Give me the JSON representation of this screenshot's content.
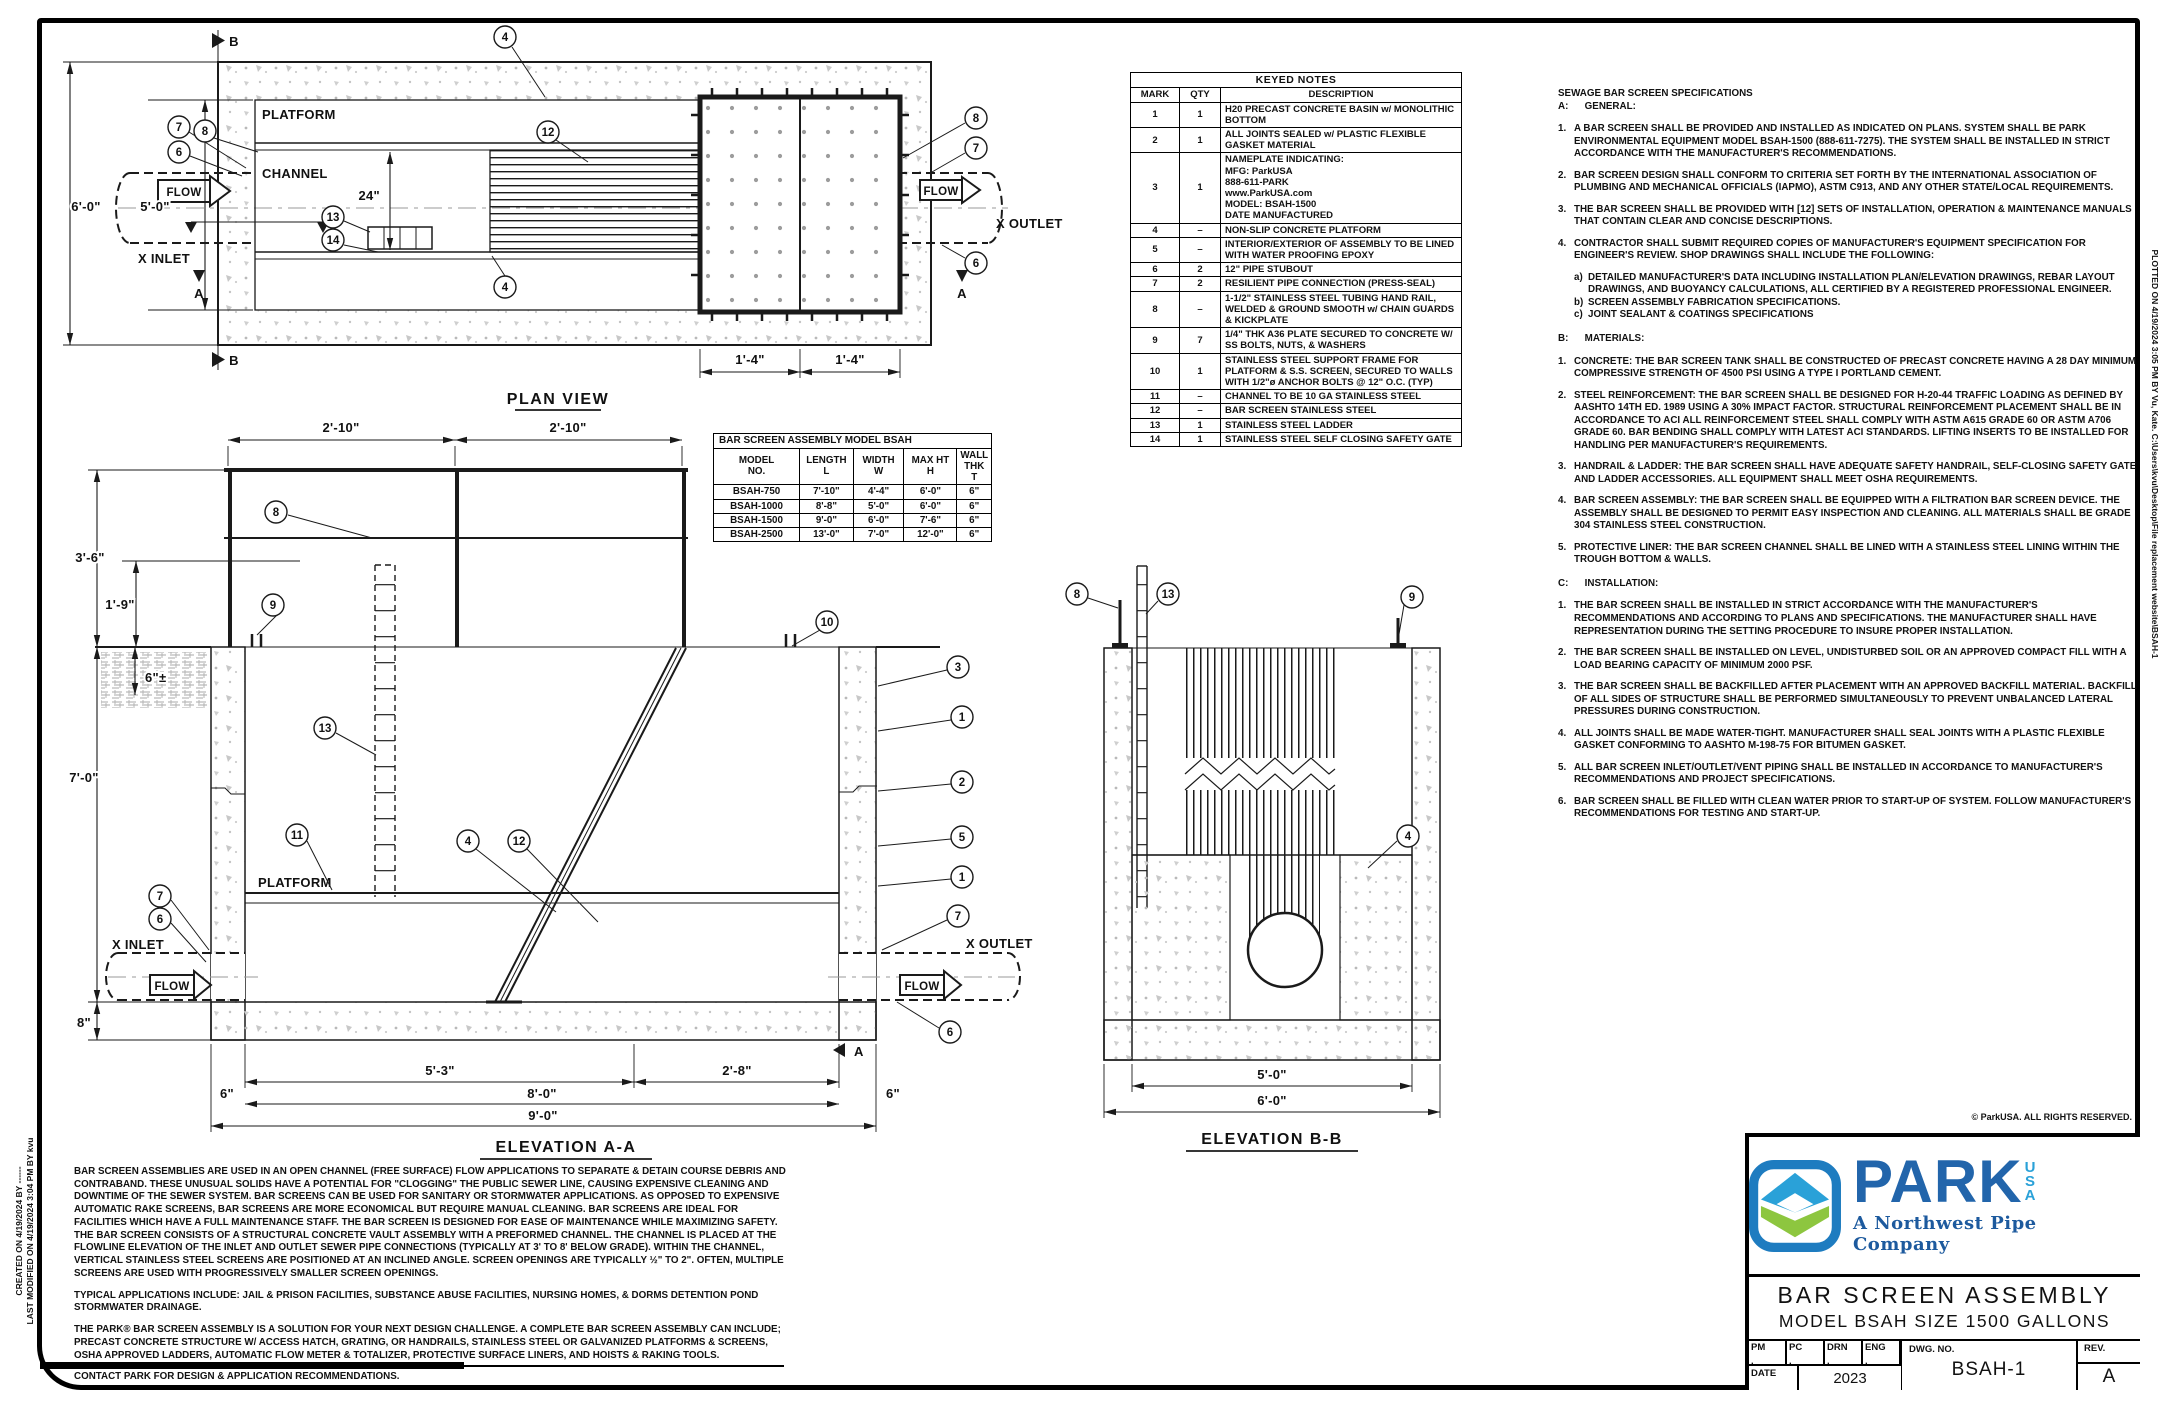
{
  "colors": {
    "line": "#1a1a1a",
    "park_blue": "#2265ab",
    "usa_blue": "#2aa1d8",
    "tagline_blue": "#1d5a9e",
    "icon_green": "#8dc63f",
    "icon_border": "#1e7cc0",
    "concrete_gray": "#c0c0c0"
  },
  "balloons": {
    "n1": "1",
    "n2": "2",
    "n3": "3",
    "n4": "4",
    "n5": "5",
    "n6": "6",
    "n7": "7",
    "n8": "8",
    "n9": "9",
    "n10": "10",
    "n11": "11",
    "n12": "12",
    "n13": "13",
    "n14": "14"
  },
  "plan": {
    "title": "PLAN VIEW",
    "platform": "PLATFORM",
    "channel": "CHANNEL",
    "x_inlet": "X INLET",
    "x_outlet": "X OUTLET",
    "flow": "FLOW",
    "dim_24": "24\"",
    "dim_6_0": "6'-0\"",
    "dim_5_0": "5'-0\"",
    "dim_1_4": "1'-4\"",
    "sec_a": "A",
    "sec_b": "B"
  },
  "elev_a": {
    "title": "ELEVATION A-A",
    "platform": "PLATFORM",
    "x_inlet": "X INLET",
    "x_outlet": "X OUTLET",
    "flow": "FLOW",
    "sec_a": "A",
    "dims": {
      "d210": "2'-10\"",
      "d36": "3'-6\"",
      "d19": "1'-9\"",
      "d6pm": "6\"±",
      "d70": "7'-0\"",
      "d8": "8\"",
      "d53": "5'-3\"",
      "d28": "2'-8\"",
      "d80": "8'-0\"",
      "d90": "9'-0\"",
      "d6": "6\""
    }
  },
  "elev_b": {
    "title": "ELEVATION B-B",
    "dims": {
      "d50": "5'-0\"",
      "d60": "6'-0\""
    }
  },
  "keyed_notes": {
    "title": "KEYED NOTES",
    "headers": {
      "mark": "MARK",
      "qty": "QTY",
      "desc": "DESCRIPTION"
    },
    "rows": [
      {
        "mark": "1",
        "qty": "1",
        "desc": "H20 PRECAST CONCRETE BASIN w/ MONOLITHIC BOTTOM"
      },
      {
        "mark": "2",
        "qty": "1",
        "desc": "ALL JOINTS SEALED w/ PLASTIC FLEXIBLE GASKET MATERIAL"
      },
      {
        "mark": "3",
        "qty": "1",
        "desc": "NAMEPLATE INDICATING:\nMFG: ParkUSA\n888-611-PARK\nwww.ParkUSA.com\nMODEL: BSAH-1500\nDATE MANUFACTURED"
      },
      {
        "mark": "4",
        "qty": "–",
        "desc": "NON-SLIP CONCRETE PLATFORM"
      },
      {
        "mark": "5",
        "qty": "–",
        "desc": "INTERIOR/EXTERIOR OF ASSEMBLY TO BE LINED WITH WATER PROOFING EPOXY"
      },
      {
        "mark": "6",
        "qty": "2",
        "desc": "12\" PIPE STUBOUT"
      },
      {
        "mark": "7",
        "qty": "2",
        "desc": "RESILIENT PIPE CONNECTION (PRESS-SEAL)"
      },
      {
        "mark": "8",
        "qty": "–",
        "desc": "1-1/2\" STAINLESS STEEL TUBING HAND RAIL, WELDED & GROUND SMOOTH w/ CHAIN GUARDS & KICKPLATE"
      },
      {
        "mark": "9",
        "qty": "7",
        "desc": "1/4\" THK A36 PLATE SECURED TO CONCRETE W/ SS BOLTS, NUTS, & WASHERS"
      },
      {
        "mark": "10",
        "qty": "1",
        "desc": "STAINLESS STEEL SUPPORT FRAME FOR PLATFORM & S.S. SCREEN, SECURED TO WALLS WITH 1/2\"ø ANCHOR BOLTS @ 12\" O.C. (TYP)"
      },
      {
        "mark": "11",
        "qty": "–",
        "desc": "CHANNEL TO BE 10 GA STAINLESS STEEL"
      },
      {
        "mark": "12",
        "qty": "–",
        "desc": "BAR SCREEN STAINLESS STEEL"
      },
      {
        "mark": "13",
        "qty": "1",
        "desc": "STAINLESS STEEL LADDER"
      },
      {
        "mark": "14",
        "qty": "1",
        "desc": "STAINLESS STEEL SELF CLOSING SAFETY GATE"
      }
    ]
  },
  "model_table": {
    "title": "BAR SCREEN ASSEMBLY MODEL BSAH",
    "headers": {
      "model": "MODEL\nNO.",
      "length": "LENGTH\nL",
      "width": "WIDTH\nW",
      "maxht": "MAX HT\nH",
      "wall": "WALL THK\nT"
    },
    "rows": [
      {
        "model": "BSAH-750",
        "l": "7'-10\"",
        "w": "4'-4\"",
        "h": "6'-0\"",
        "t": "6\""
      },
      {
        "model": "BSAH-1000",
        "l": "8'-8\"",
        "w": "5'-0\"",
        "h": "6'-0\"",
        "t": "6\""
      },
      {
        "model": "BSAH-1500",
        "l": "9'-0\"",
        "w": "6'-0\"",
        "h": "7'-6\"",
        "t": "6\""
      },
      {
        "model": "BSAH-2500",
        "l": "13'-0\"",
        "w": "7'-0\"",
        "h": "12'-0\"",
        "t": "6\""
      }
    ]
  },
  "specs": {
    "title": "SEWAGE BAR SCREEN SPECIFICATIONS",
    "a_head": "A:      GENERAL:",
    "a": [
      {
        "n": "1.",
        "t": "A BAR SCREEN SHALL BE PROVIDED AND INSTALLED AS INDICATED ON PLANS.  SYSTEM SHALL BE PARK ENVIRONMENTAL EQUIPMENT MODEL BSAH-1500 (888-611-7275). THE SYSTEM SHALL BE INSTALLED IN STRICT ACCORDANCE WITH THE MANUFACTURER'S RECOMMENDATIONS."
      },
      {
        "n": "2.",
        "t": "BAR SCREEN DESIGN SHALL CONFORM TO CRITERIA SET FORTH BY THE INTERNATIONAL ASSOCIATION OF PLUMBING AND MECHANICAL OFFICIALS (IAPMO), ASTM C913, AND ANY OTHER STATE/LOCAL REQUIREMENTS."
      },
      {
        "n": "3.",
        "t": "THE BAR SCREEN SHALL BE PROVIDED WITH [12] SETS OF INSTALLATION, OPERATION & MAINTENANCE MANUALS THAT CONTAIN CLEAR AND CONCISE DESCRIPTIONS."
      },
      {
        "n": "4.",
        "t": "CONTRACTOR SHALL SUBMIT REQUIRED COPIES OF MANUFACTURER'S EQUIPMENT SPECIFICATION FOR ENGINEER'S REVIEW.  SHOP DRAWINGS SHALL INCLUDE THE FOLLOWING:"
      }
    ],
    "a4_subs": [
      {
        "n": "a)",
        "t": "DETAILED MANUFACTURER'S DATA INCLUDING INSTALLATION PLAN/ELEVATION DRAWINGS, REBAR LAYOUT DRAWINGS, AND BUOYANCY CALCULATIONS, ALL CERTIFIED BY A REGISTERED PROFESSIONAL ENGINEER."
      },
      {
        "n": "b)",
        "t": "SCREEN ASSEMBLY FABRICATION SPECIFICATIONS."
      },
      {
        "n": "c)",
        "t": "JOINT SEALANT & COATINGS SPECIFICATIONS"
      }
    ],
    "b_head": "B:      MATERIALS:",
    "b": [
      {
        "n": "1.",
        "t": "CONCRETE: THE BAR SCREEN TANK SHALL BE CONSTRUCTED OF PRECAST CONCRETE HAVING A 28 DAY MINIMUM COMPRESSIVE STRENGTH OF 4500 PSI USING A TYPE I PORTLAND CEMENT."
      },
      {
        "n": "2.",
        "t": "STEEL REINFORCEMENT: THE BAR SCREEN SHALL BE DESIGNED FOR H-20-44 TRAFFIC LOADING AS DEFINED BY AASHTO 14TH ED. 1989 USING A 30% IMPACT FACTOR.  STRUCTURAL REINFORCEMENT PLACEMENT SHALL BE IN ACCORDANCE TO ACI ALL REINFORCEMENT STEEL SHALL COMPLY WITH ASTM A615 GRADE 60 OR ASTM A706 GRADE 60.  BAR BENDING SHALL COMPLY WITH LATEST ACI STANDARDS. LIFTING INSERTS TO BE INSTALLED FOR HANDLING PER MANUFACTURER'S REQUIREMENTS."
      },
      {
        "n": "3.",
        "t": "HANDRAIL & LADDER: THE BAR SCREEN SHALL HAVE ADEQUATE SAFETY HANDRAIL, SELF-CLOSING SAFETY GATE AND LADDER ACCESSORIES. ALL EQUIPMENT SHALL MEET OSHA REQUIREMENTS."
      },
      {
        "n": "4.",
        "t": "BAR SCREEN ASSEMBLY: THE BAR SCREEN SHALL BE EQUIPPED WITH A FILTRATION BAR SCREEN DEVICE. THE ASSEMBLY SHALL BE DESIGNED TO PERMIT EASY INSPECTION AND CLEANING. ALL MATERIALS SHALL BE GRADE 304 STAINLESS STEEL CONSTRUCTION."
      },
      {
        "n": "5.",
        "t": "PROTECTIVE LINER: THE BAR SCREEN CHANNEL SHALL BE LINED WITH A STAINLESS STEEL LINING WITHIN THE TROUGH BOTTOM & WALLS."
      }
    ],
    "c_head": "C:      INSTALLATION:",
    "c": [
      {
        "n": "1.",
        "t": "THE BAR SCREEN SHALL BE INSTALLED IN STRICT ACCORDANCE WITH THE MANUFACTURER'S RECOMMENDATIONS AND ACCORDING TO PLANS AND SPECIFICATIONS.  THE MANUFACTURER SHALL HAVE REPRESENTATION DURING THE SETTING PROCEDURE TO INSURE PROPER INSTALLATION."
      },
      {
        "n": "2.",
        "t": "THE BAR SCREEN SHALL BE INSTALLED ON LEVEL, UNDISTURBED SOIL OR AN APPROVED COMPACT FILL WITH A LOAD BEARING CAPACITY OF MINIMUM 2000 PSF."
      },
      {
        "n": "3.",
        "t": "THE BAR SCREEN SHALL BE BACKFILLED AFTER PLACEMENT WITH AN APPROVED BACKFILL MATERIAL.  BACKFILL OF ALL SIDES OF STRUCTURE SHALL BE PERFORMED SIMULTANEOUSLY TO PREVENT UNBALANCED LATERAL PRESSURES DURING CONSTRUCTION."
      },
      {
        "n": "4.",
        "t": "ALL JOINTS SHALL BE MADE WATER-TIGHT.  MANUFACTURER SHALL SEAL JOINTS WITH A PLASTIC FLEXIBLE GASKET CONFORMING TO AASHTO M-198-75 FOR BITUMEN GASKET."
      },
      {
        "n": "5.",
        "t": "ALL BAR SCREEN INLET/OUTLET/VENT PIPING SHALL BE INSTALLED IN ACCORDANCE TO MANUFACTURER'S RECOMMENDATIONS AND PROJECT SPECIFICATIONS."
      },
      {
        "n": "6.",
        "t": "BAR SCREEN SHALL BE FILLED WITH CLEAN WATER PRIOR TO START-UP OF SYSTEM.  FOLLOW MANUFACTURER'S RECOMMENDATIONS FOR TESTING AND START-UP."
      }
    ]
  },
  "description": {
    "p1": "BAR SCREEN ASSEMBLIES ARE USED IN AN OPEN CHANNEL (FREE SURFACE) FLOW APPLICATIONS TO SEPARATE & DETAIN COURSE DEBRIS AND CONTRABAND. THESE UNUSUAL SOLIDS HAVE A POTENTIAL FOR \"CLOGGING\" THE PUBLIC SEWER LINE, CAUSING EXPENSIVE CLEANING AND DOWNTIME OF THE SEWER SYSTEM. BAR SCREENS CAN BE USED FOR SANITARY OR STORMWATER APPLICATIONS. AS OPPOSED TO EXPENSIVE AUTOMATIC RAKE SCREENS, BAR SCREENS ARE MORE ECONOMICAL BUT REQUIRE MANUAL CLEANING. BAR SCREENS ARE IDEAL FOR FACILITIES WHICH HAVE A FULL MAINTENANCE STAFF. THE BAR SCREEN IS DESIGNED FOR EASE OF MAINTENANCE WHILE MAXIMIZING SAFETY. THE BAR SCREEN CONSISTS OF A STRUCTURAL CONCRETE VAULT ASSEMBLY WITH A PREFORMED CHANNEL. THE CHANNEL IS PLACED AT THE FLOWLINE ELEVATION OF THE INLET AND OUTLET SEWER PIPE CONNECTIONS (TYPICALLY AT 3' TO 8' BELOW GRADE). WITHIN THE CHANNEL, VERTICAL STAINLESS STEEL SCREENS ARE POSITIONED AT AN INCLINED ANGLE. SCREEN OPENINGS ARE TYPICALLY ½\" TO 2\". OFTEN, MULTIPLE SCREENS ARE USED WITH PROGRESSIVELY SMALLER SCREEN OPENINGS.",
    "p2": "TYPICAL APPLICATIONS INCLUDE: JAIL & PRISON FACILITIES, SUBSTANCE ABUSE FACILITIES, NURSING HOMES, & DORMS DETENTION POND STORMWATER DRAINAGE.",
    "p3": "THE PARK® BAR SCREEN ASSEMBLY IS A SOLUTION FOR YOUR NEXT DESIGN CHALLENGE. A COMPLETE BAR SCREEN ASSEMBLY CAN INCLUDE; PRECAST CONCRETE STRUCTURE W/ ACCESS HATCH, GRATING, OR HANDRAILS, STAINLESS STEEL OR GALVANIZED PLATFORMS & SCREENS, OSHA APPROVED LADDERS, AUTOMATIC FLOW METER & TOTALIZER, PROTECTIVE SURFACE LINERS, AND HOISTS & RAKING TOOLS.",
    "p4": "CONTACT PARK FOR DESIGN & APPLICATION RECOMMENDATIONS."
  },
  "titleblock": {
    "copyright": "© ParkUSA. ALL RIGHTS RESERVED.",
    "brand": "PARK",
    "usa": "USA",
    "tagline": "A Northwest Pipe Company",
    "title1": "BAR SCREEN ASSEMBLY",
    "title2": "MODEL BSAH SIZE 1500 GALLONS",
    "pm": "PM",
    "pc": "PC",
    "drn": "DRN",
    "eng": "ENG",
    "dot": ".",
    "date_label": "DATE",
    "date": "2023",
    "dwg_label": "DWG. NO.",
    "dwg_no": "BSAH-1",
    "rev_label": "REV.",
    "rev": "A"
  },
  "edge": {
    "left1": "CREATED ON 4/19/2024 BY ------",
    "left2": "LAST MODIFIED ON 4/19/2024 3:04 PM BY kvu",
    "right": "PLOTTED ON 4/19/2024 3:05 PM BY Vu, Kate. C:\\Users\\kvu\\Desktop\\File replacement website\\BSAH-1"
  }
}
